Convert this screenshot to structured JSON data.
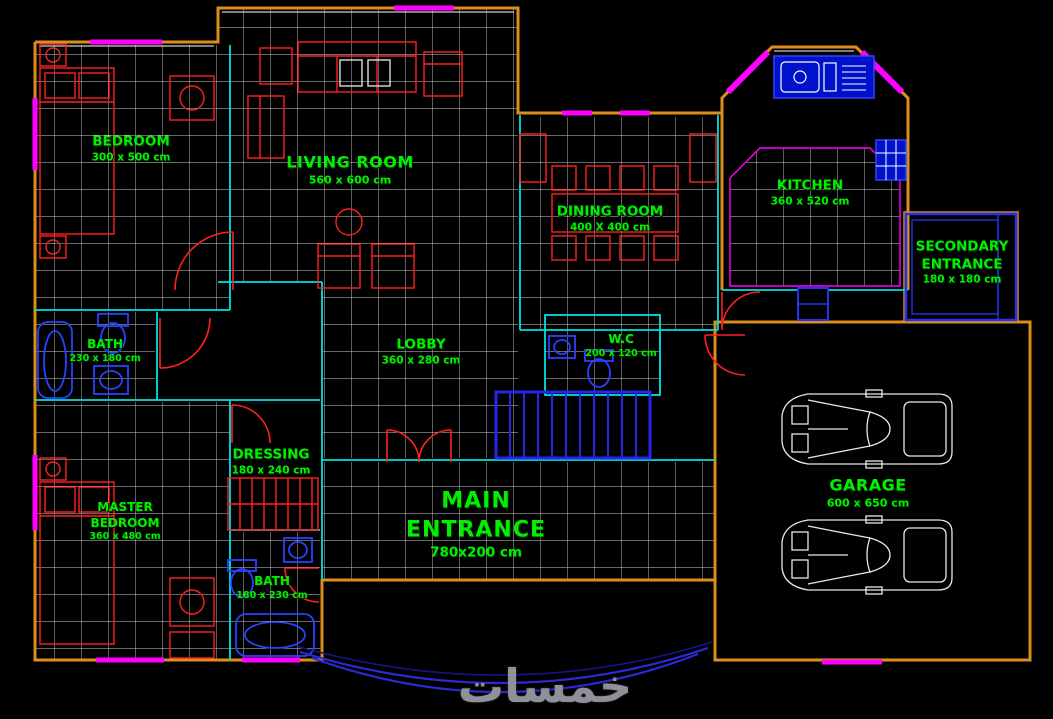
{
  "watermark": {
    "text": "خمسات"
  },
  "colors": {
    "background": "#000000",
    "label_green": "#00f000",
    "walls_orange": "#dd8c1e",
    "windows_magenta": "#ff00ff",
    "fixtures_blue": "#2742ff",
    "furniture_red": "#ff2020",
    "tile_grid_white": "#cfcfcf",
    "interior_walls_cyan": "#00e0e0",
    "stairs_blue": "#2626e6",
    "car_outline_white": "#e8e8e8"
  },
  "rooms": [
    {
      "id": "bedroom",
      "name": "BEDROOM",
      "dims": "300 x 500 cm"
    },
    {
      "id": "living-room",
      "name": "LIVING ROOM",
      "dims": "560 x 600 cm"
    },
    {
      "id": "dining-room",
      "name": "DINING ROOM",
      "dims": "400 X 400 cm"
    },
    {
      "id": "kitchen",
      "name": "KITCHEN",
      "dims": "360 x 520 cm"
    },
    {
      "id": "secondary-entrance",
      "name": "SECONDARY ENTRANCE",
      "dims": "180 x 180 cm"
    },
    {
      "id": "bath-top",
      "name": "BATH",
      "dims": "230 x 180 cm"
    },
    {
      "id": "lobby",
      "name": "LOBBY",
      "dims": "360 x 280 cm"
    },
    {
      "id": "wc",
      "name": "W.C",
      "dims": "200 x 120 cm"
    },
    {
      "id": "dressing",
      "name": "DRESSING",
      "dims": "180 x 240 cm"
    },
    {
      "id": "master-bedroom",
      "name": "MASTER BEDROOM",
      "dims": "360 x 480 cm"
    },
    {
      "id": "bath-bottom",
      "name": "BATH",
      "dims": "180 x 230 cm"
    },
    {
      "id": "main-entrance",
      "name": "MAIN ENTRANCE",
      "dims": "780x200 cm"
    },
    {
      "id": "garage",
      "name": "GARAGE",
      "dims": "600 x 650 cm"
    }
  ]
}
